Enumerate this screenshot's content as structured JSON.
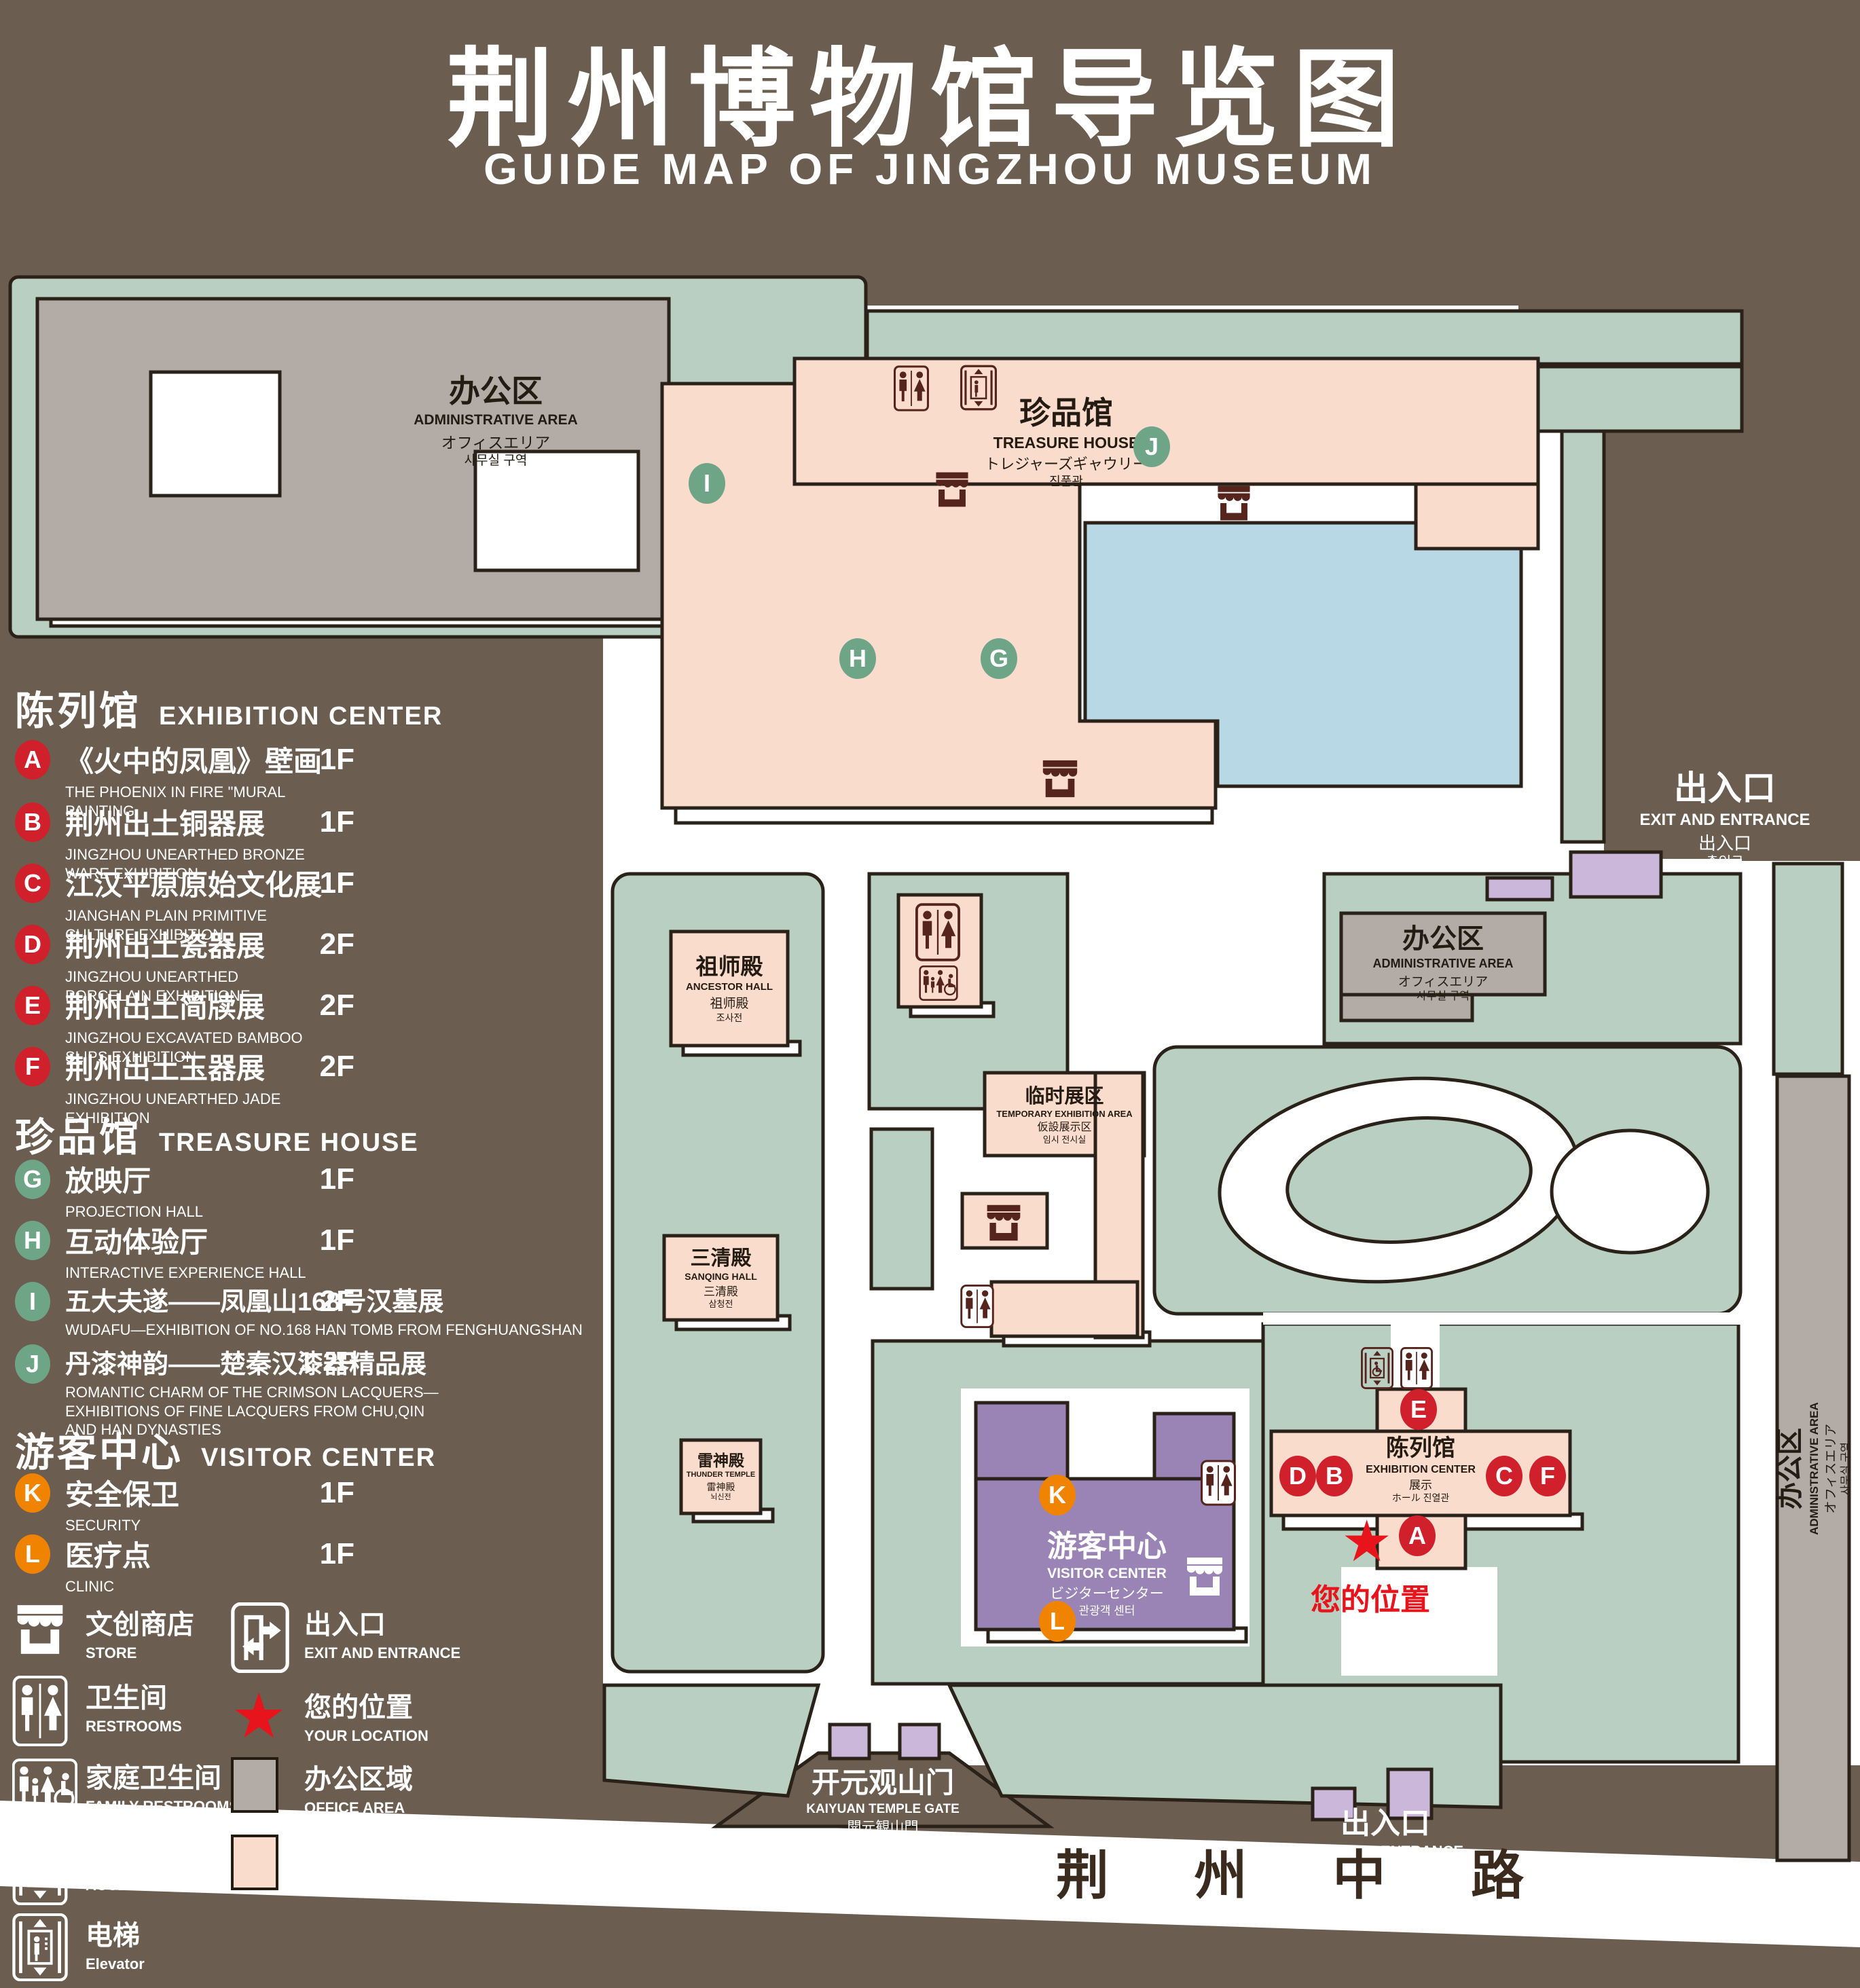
{
  "title": {
    "cn": "荆州博物馆导览图",
    "en": "GUIDE MAP OF JINGZHOU MUSEUM"
  },
  "colors": {
    "background": "#6b5d50",
    "lawn": "#b9cfc2",
    "display_area": "#fadccd",
    "office_area": "#b3aca6",
    "visitor_center": "#9a84b6",
    "light_purple": "#cab7d9",
    "pond": "#b9d8e5",
    "outline": "#2a2119",
    "badge_red": "#d0202c",
    "badge_green": "#6fa587",
    "badge_orange": "#f08300",
    "location_red": "#e8141c",
    "icon_brown": "#55251d",
    "road_text": "#3a2b1e"
  },
  "legend": {
    "sections": [
      {
        "cn": "陈列馆",
        "en": "EXHIBITION CENTER",
        "items": [
          {
            "key": "A",
            "cn": "《火中的凤凰》壁画",
            "en": "THE PHOENIX IN FIRE \"MURAL PAINTING",
            "floor": "1F"
          },
          {
            "key": "B",
            "cn": "荆州出土铜器展",
            "en": "JINGZHOU UNEARTHED BRONZE WARE EXHIBITION",
            "floor": "1F"
          },
          {
            "key": "C",
            "cn": "江汉平原原始文化展",
            "en": "JIANGHAN PLAIN PRIMITIVE CULTURE EXHIBITION",
            "floor": "1F"
          },
          {
            "key": "D",
            "cn": "荆州出土瓷器展",
            "en": "JINGZHOU UNEARTHED PORCELAIN EXHIBITIONE",
            "floor": "2F"
          },
          {
            "key": "E",
            "cn": "荆州出土简牍展",
            "en": "JINGZHOU EXCAVATED BAMBOO SLIPS EXHIBITION",
            "floor": "2F"
          },
          {
            "key": "F",
            "cn": "荆州出土玉器展",
            "en": "JINGZHOU UNEARTHED JADE EXHIBITION",
            "floor": "2F"
          }
        ]
      },
      {
        "cn": "珍品馆",
        "en": "TREASURE HOUSE",
        "items": [
          {
            "key": "G",
            "cn": "放映厅",
            "en": "PROJECTION HALL",
            "floor": "1F"
          },
          {
            "key": "H",
            "cn": "互动体验厅",
            "en": "INTERACTIVE EXPERIENCE HALL",
            "floor": "1F"
          },
          {
            "key": "I",
            "cn": "五大夫遂——凤凰山168号汉墓展",
            "en": "WUDAFU—EXHIBITION OF NO.168 HAN TOMB FROM FENGHUANGSHAN",
            "floor": "2F"
          },
          {
            "key": "J",
            "cn": "丹漆神韵——楚秦汉漆器精品展",
            "en": "ROMANTIC CHARM OF THE CRIMSON LACQUERS—EXHIBITIONS OF FINE LACQUERS FROM CHU,QIN AND HAN DYNASTIES",
            "floor": "1-2F"
          }
        ]
      },
      {
        "cn": "游客中心",
        "en": "VISITOR CENTER",
        "items": [
          {
            "key": "K",
            "cn": "安全保卫",
            "en": "SECURITY",
            "floor": "1F"
          },
          {
            "key": "L",
            "cn": "医疗点",
            "en": "CLINIC",
            "floor": "1F"
          }
        ]
      }
    ],
    "symbols": [
      {
        "icon": "store-icon",
        "cn": "文创商店",
        "en": "STORE"
      },
      {
        "icon": "exit-icon",
        "cn": "出入口",
        "en": "EXIT AND ENTRANCE"
      },
      {
        "icon": "restrooms-icon",
        "cn": "卫生间",
        "en": "RESTROOMS"
      },
      {
        "icon": "location-star-icon",
        "cn": "您的位置",
        "en": "YOUR LOCATION"
      },
      {
        "icon": "family-restrooms-icon",
        "cn": "家庭卫生间",
        "en": "FAMILY RESTROOMS"
      },
      {
        "icon": "office-area-swatch",
        "cn": "办公区域",
        "en": "OFFICE AREA"
      },
      {
        "icon": "accessible-elevator-icon",
        "cn": "无障碍电梯",
        "en": "ACCESSIBLE ELEVATOR"
      },
      {
        "icon": "display-area-swatch",
        "cn": "展示区域",
        "en": "DISPLAY AREA"
      },
      {
        "icon": "elevator-icon",
        "cn": "电梯",
        "en": "Elevator"
      }
    ]
  },
  "map": {
    "admin": [
      "办公区",
      "ADMINISTRATIVE AREA",
      "オフィスエリア",
      "사무실 구역"
    ],
    "th": [
      "珍品馆",
      "TREASURE HOUSE",
      "トレジャーズギャウリー",
      "진품관"
    ],
    "ancestor": [
      "祖师殿",
      "ANCESTOR HALL",
      "祖师殿",
      "조사전"
    ],
    "sanqing": [
      "三清殿",
      "SANQING HALL",
      "三清殿",
      "삼청전"
    ],
    "thunder": [
      "雷神殿",
      "THUNDER TEMPLE",
      "雷神殿",
      "뇌신전"
    ],
    "temp": [
      "临时展区",
      "TEMPORARY EXHIBITION AREA",
      "仮設展示区",
      "임시 전시실"
    ],
    "visitor": [
      "游客中心",
      "VISITOR CENTER",
      "ビジターセンター",
      "관광객 센터"
    ],
    "exhibition": [
      "陈列馆",
      "EXHIBITION CENTER",
      "展示",
      "ホール 진열관"
    ],
    "gate": [
      "开元观山门",
      "KAIYUAN TEMPLE GATE",
      "開元観山門",
      "산문을 열다"
    ],
    "exit": [
      "出入口",
      "EXIT AND ENTRANCE",
      "出入口",
      "출입구"
    ],
    "your_location": "您的位置",
    "road": "荆 州 中 路",
    "markers": {
      "a": "A",
      "b": "B",
      "c": "C",
      "d": "D",
      "e": "E",
      "f": "F",
      "g": "G",
      "h": "H",
      "i": "I",
      "j": "J",
      "k": "K",
      "l": "L"
    }
  }
}
